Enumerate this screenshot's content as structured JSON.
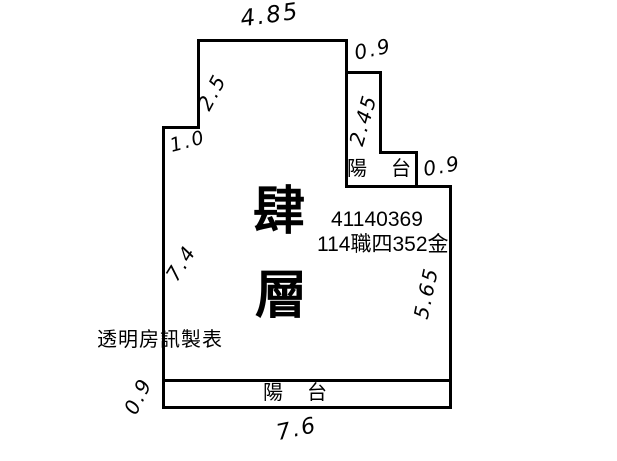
{
  "colors": {
    "ink": "#000000",
    "paper": "#ffffff"
  },
  "plan": {
    "floor_char_top": "肆",
    "floor_char_bottom": "層",
    "id_number": "41140369",
    "case_code": "114職四352金",
    "maker_note": "透明房訊製表",
    "balcony_label_top": "陽　台",
    "balcony_label_bottom": "陽　台",
    "dimensions": {
      "top_width": "4.85",
      "top_right_inset": "0.9",
      "upper_left_height": "2.5",
      "upper_left_inset": "1.0",
      "balcony_depth": "2.45",
      "balcony_step_width": "0.9",
      "right_height": "5.65",
      "left_height": "7.4",
      "bottom_balcony_depth": "0.9",
      "bottom_width": "7.6"
    }
  }
}
